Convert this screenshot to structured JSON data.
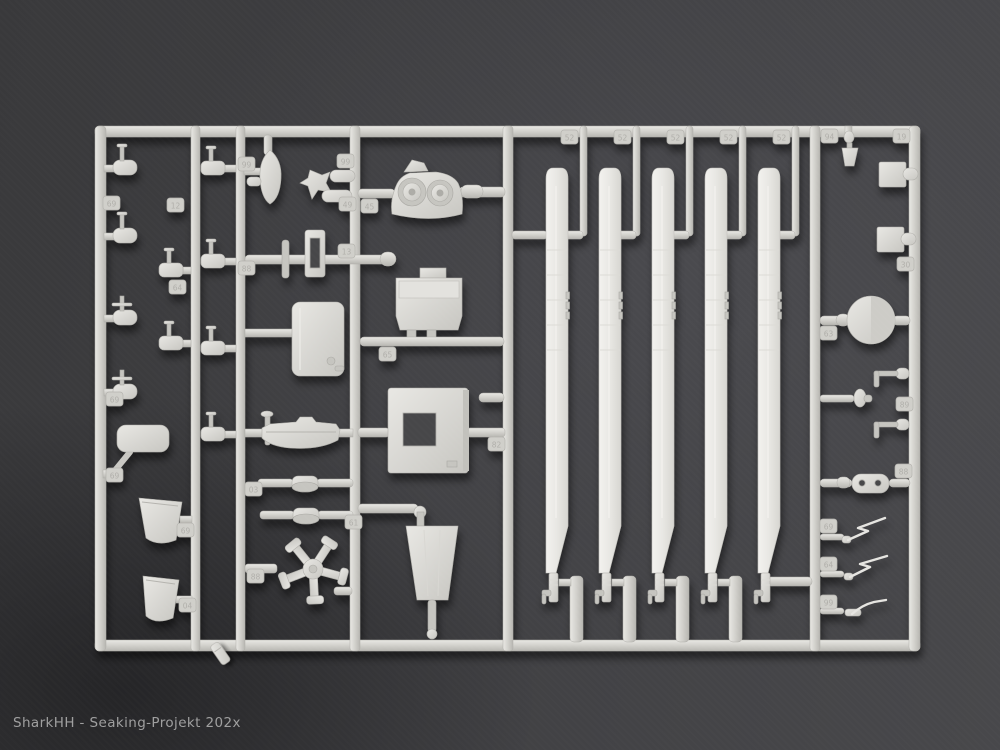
{
  "scene": {
    "type": "photograph",
    "subject": "Light grey injection-moulded model kit sprue with helicopter parts (five main rotor blades, rotor hub, intake fairing, sponson, doors, wipers and many small fittings) lying on a dark grey background; one small broken-off piece lies loose below the frame",
    "watermark": "SharkHH - Seaking-Projekt 202x",
    "colors": {
      "background": "#414144",
      "background_shadow": "#2d2d2f",
      "plastic_base": "#d6d5d0",
      "plastic_highlight": "#edece8",
      "plastic_shadow": "#a5a49f",
      "blade_plastic": "#eceae6",
      "watermark_text": "#acacac"
    }
  },
  "sprue": {
    "tabs": [
      {
        "label": "69"
      },
      {
        "label": "12"
      },
      {
        "label": "64"
      },
      {
        "label": "69"
      },
      {
        "label": "69"
      },
      {
        "label": "69"
      },
      {
        "label": "04"
      },
      {
        "label": "99"
      },
      {
        "label": "88"
      },
      {
        "label": "03"
      },
      {
        "label": "88"
      },
      {
        "label": "99"
      },
      {
        "label": "49"
      },
      {
        "label": "13"
      },
      {
        "label": "61"
      },
      {
        "label": "45"
      },
      {
        "label": "65"
      },
      {
        "label": "82"
      },
      {
        "label": "52"
      },
      {
        "label": "52"
      },
      {
        "label": "52"
      },
      {
        "label": "52"
      },
      {
        "label": "52"
      },
      {
        "label": "94"
      },
      {
        "label": "19"
      },
      {
        "label": "30"
      },
      {
        "label": "63"
      },
      {
        "label": "89"
      },
      {
        "label": "88"
      },
      {
        "label": "69"
      },
      {
        "label": "64"
      },
      {
        "label": "99"
      }
    ],
    "parts": [
      "rotor-blade x5",
      "rotor-hub-5-arm",
      "twin-intake-fairing",
      "equipment-box",
      "access-panel-with-hatch",
      "trapezoid-tub",
      "teardrop-fairing",
      "cabin-door-panel",
      "sponson-hull",
      "pulley-disc x2",
      "step-frame",
      "mirror",
      "intake-scoop x2",
      "valve-fitting x8",
      "goblet-fitting",
      "block-with-knob x2",
      "wheel-disc",
      "plunger",
      "l-bracket-antenna x2",
      "oval-plate-two-holes",
      "wiper x3",
      "loose-broken-piece"
    ]
  }
}
